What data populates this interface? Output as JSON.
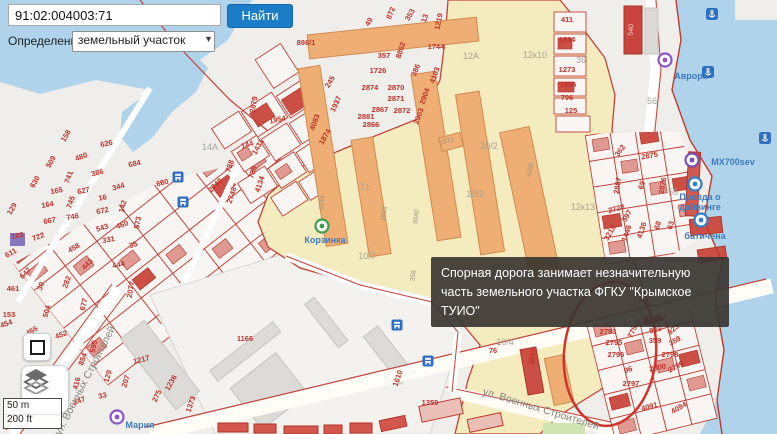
{
  "app": {
    "search_value": "91:02:004003:71",
    "search_button": "Найти",
    "definition_label": "Определение:",
    "definition_value": "земельный участок",
    "dropdown_chevron": "▾"
  },
  "tooltip": {
    "text": "Спорная дорога занимает незначительную часть земельного участка ФГКУ \"Крымское ТУИО\""
  },
  "scalebar": {
    "metric": "50 m",
    "imperial": "200 ft"
  },
  "colors": {
    "water": "#aed3ea",
    "land": "#f0eeea",
    "yellow_zone": "#f4ecbe",
    "orange_building": "#efae74",
    "red_building": "#cb4f44",
    "parcel_line": "#c2423a",
    "parcel_number": "#c0322a",
    "poi_blue": "#3d7cc0",
    "accent_blue": "#1a7dc6",
    "tooltip_bg": "#3b3733",
    "annotation_red": "#d0342c"
  },
  "map": {
    "labels": [
      {
        "t": "49",
        "x": 371,
        "y": 23,
        "r": -60
      },
      {
        "t": "872",
        "x": 393,
        "y": 14,
        "r": -68
      },
      {
        "t": "353",
        "x": 412,
        "y": 16,
        "r": -60
      },
      {
        "t": "13",
        "x": 427,
        "y": 19,
        "r": -72
      },
      {
        "t": "1219",
        "x": 441,
        "y": 22,
        "r": -78
      },
      {
        "t": "1744",
        "x": 436,
        "y": 49,
        "s": 9
      },
      {
        "t": "8862",
        "x": 403,
        "y": 51,
        "r": -72
      },
      {
        "t": "357",
        "x": 384,
        "y": 58
      },
      {
        "t": "1726",
        "x": 378,
        "y": 73
      },
      {
        "t": "386",
        "x": 418,
        "y": 71,
        "r": -68
      },
      {
        "t": "4103",
        "x": 437,
        "y": 76,
        "r": -70
      },
      {
        "t": "2874",
        "x": 370,
        "y": 90
      },
      {
        "t": "2870",
        "x": 396,
        "y": 90
      },
      {
        "t": "2904",
        "x": 427,
        "y": 97,
        "r": -70
      },
      {
        "t": "2871",
        "x": 396,
        "y": 101
      },
      {
        "t": "2867",
        "x": 380,
        "y": 112
      },
      {
        "t": "2872",
        "x": 402,
        "y": 113
      },
      {
        "t": "2903",
        "x": 421,
        "y": 117,
        "r": -70
      },
      {
        "t": "2881",
        "x": 366,
        "y": 119
      },
      {
        "t": "2866",
        "x": 371,
        "y": 127
      },
      {
        "t": "898/1",
        "x": 306,
        "y": 45,
        "s": 9
      },
      {
        "t": "411",
        "x": 567,
        "y": 22
      },
      {
        "t": "1834",
        "x": 567,
        "y": 42
      },
      {
        "t": "1273",
        "x": 567,
        "y": 72
      },
      {
        "t": "1856",
        "x": 568,
        "y": 87
      },
      {
        "t": "796",
        "x": 567,
        "y": 100
      },
      {
        "t": "125",
        "x": 571,
        "y": 113
      },
      {
        "t": "362",
        "x": 622,
        "y": 152,
        "r": -55
      },
      {
        "t": "2875",
        "x": 650,
        "y": 158,
        "r": -10
      },
      {
        "t": "2887",
        "x": 620,
        "y": 186,
        "r": -80
      },
      {
        "t": "69",
        "x": 644,
        "y": 186,
        "r": -72
      },
      {
        "t": "2876",
        "x": 665,
        "y": 186,
        "r": -80
      },
      {
        "t": "2728",
        "x": 617,
        "y": 211,
        "r": -15
      },
      {
        "t": "597",
        "x": 629,
        "y": 217,
        "r": -60
      },
      {
        "t": "3218",
        "x": 612,
        "y": 234,
        "r": -60
      },
      {
        "t": "1446",
        "x": 629,
        "y": 234,
        "r": -72
      },
      {
        "t": "4136",
        "x": 644,
        "y": 231,
        "r": -72
      },
      {
        "t": "68",
        "x": 660,
        "y": 226,
        "r": -72
      },
      {
        "t": "63",
        "x": 673,
        "y": 226,
        "r": -72
      },
      {
        "t": "2793",
        "x": 608,
        "y": 334
      },
      {
        "t": "775/1",
        "x": 636,
        "y": 330,
        "r": -65
      },
      {
        "t": "923",
        "x": 656,
        "y": 332,
        "r": -15
      },
      {
        "t": "923",
        "x": 675,
        "y": 331,
        "r": -42
      },
      {
        "t": "2795",
        "x": 614,
        "y": 345
      },
      {
        "t": "359",
        "x": 655,
        "y": 343
      },
      {
        "t": "359",
        "x": 676,
        "y": 343,
        "r": -30
      },
      {
        "t": "2796",
        "x": 616,
        "y": 357
      },
      {
        "t": "2798",
        "x": 670,
        "y": 357
      },
      {
        "t": "96",
        "x": 629,
        "y": 372,
        "r": -20
      },
      {
        "t": "2800",
        "x": 658,
        "y": 370,
        "r": -10
      },
      {
        "t": "2799",
        "x": 677,
        "y": 369,
        "r": -28
      },
      {
        "t": "2797",
        "x": 631,
        "y": 386
      },
      {
        "t": "4091",
        "x": 650,
        "y": 409,
        "r": -15
      },
      {
        "t": "4094",
        "x": 680,
        "y": 410,
        "r": -30
      },
      {
        "t": "2879",
        "x": 256,
        "y": 105,
        "r": -80
      },
      {
        "t": "1954",
        "x": 278,
        "y": 122,
        "r": -12
      },
      {
        "t": "245",
        "x": 332,
        "y": 83,
        "r": -60
      },
      {
        "t": "1937",
        "x": 338,
        "y": 105,
        "r": -65
      },
      {
        "t": "4083",
        "x": 317,
        "y": 123,
        "r": -70
      },
      {
        "t": "1874",
        "x": 327,
        "y": 138,
        "r": -60
      },
      {
        "t": "144",
        "x": 248,
        "y": 147,
        "r": -18
      },
      {
        "t": "1431",
        "x": 260,
        "y": 148,
        "r": -60
      },
      {
        "t": "788",
        "x": 232,
        "y": 167,
        "r": -70
      },
      {
        "t": "788",
        "x": 255,
        "y": 173,
        "r": -70
      },
      {
        "t": "4134",
        "x": 262,
        "y": 185,
        "r": -72
      },
      {
        "t": "2749",
        "x": 217,
        "y": 187,
        "r": -45
      },
      {
        "t": "2748",
        "x": 234,
        "y": 196,
        "r": -72
      },
      {
        "t": "158",
        "x": 68,
        "y": 137,
        "r": -60
      },
      {
        "t": "509",
        "x": 53,
        "y": 163,
        "r": -60
      },
      {
        "t": "480",
        "x": 82,
        "y": 159,
        "r": -20
      },
      {
        "t": "630",
        "x": 37,
        "y": 183,
        "r": -60
      },
      {
        "t": "741",
        "x": 71,
        "y": 178,
        "r": -70
      },
      {
        "t": "386",
        "x": 98,
        "y": 175,
        "r": -15
      },
      {
        "t": "344",
        "x": 119,
        "y": 189,
        "r": -15
      },
      {
        "t": "165",
        "x": 57,
        "y": 193,
        "r": -10
      },
      {
        "t": "627",
        "x": 84,
        "y": 193,
        "r": -12
      },
      {
        "t": "16",
        "x": 103,
        "y": 200,
        "r": -10
      },
      {
        "t": "129",
        "x": 14,
        "y": 210,
        "r": -60
      },
      {
        "t": "164",
        "x": 48,
        "y": 207,
        "r": -12
      },
      {
        "t": "745",
        "x": 73,
        "y": 203,
        "r": -70
      },
      {
        "t": "746",
        "x": 73,
        "y": 219,
        "r": -10
      },
      {
        "t": "142",
        "x": 125,
        "y": 207,
        "r": -75
      },
      {
        "t": "667",
        "x": 50,
        "y": 223,
        "r": -10
      },
      {
        "t": "672",
        "x": 103,
        "y": 213,
        "r": -12
      },
      {
        "t": "543",
        "x": 103,
        "y": 230,
        "r": -18
      },
      {
        "t": "460",
        "x": 123,
        "y": 227,
        "r": -20
      },
      {
        "t": "573",
        "x": 140,
        "y": 223,
        "r": -80
      },
      {
        "t": "722",
        "x": 39,
        "y": 239,
        "r": -20
      },
      {
        "t": "103",
        "x": 18,
        "y": 238,
        "r": -12
      },
      {
        "t": "331",
        "x": 109,
        "y": 242,
        "r": -12
      },
      {
        "t": "611",
        "x": 12,
        "y": 255,
        "r": -30
      },
      {
        "t": "458",
        "x": 75,
        "y": 250,
        "r": -30
      },
      {
        "t": "443",
        "x": 89,
        "y": 266,
        "r": -45
      },
      {
        "t": "455",
        "x": 33,
        "y": 333,
        "r": -30
      },
      {
        "t": "153",
        "x": 9,
        "y": 317
      },
      {
        "t": "454",
        "x": 7,
        "y": 326,
        "r": -20
      },
      {
        "t": "647",
        "x": 27,
        "y": 275,
        "r": -45
      },
      {
        "t": "461",
        "x": 13,
        "y": 291
      },
      {
        "t": "30",
        "x": 43,
        "y": 287,
        "r": -70
      },
      {
        "t": "504",
        "x": 49,
        "y": 312,
        "r": -75
      },
      {
        "t": "282",
        "x": 69,
        "y": 283,
        "r": -70
      },
      {
        "t": "677",
        "x": 86,
        "y": 305,
        "r": -75
      },
      {
        "t": "444",
        "x": 119,
        "y": 267,
        "r": -12
      },
      {
        "t": "35",
        "x": 134,
        "y": 247,
        "r": -18
      },
      {
        "t": "2077",
        "x": 133,
        "y": 290,
        "r": -80
      },
      {
        "t": "626",
        "x": 107,
        "y": 146,
        "r": -12,
        "s": 9
      },
      {
        "t": "684",
        "x": 135,
        "y": 166,
        "r": -12,
        "s": 9
      },
      {
        "t": "680",
        "x": 163,
        "y": 185,
        "r": -15,
        "s": 9
      },
      {
        "t": "452",
        "x": 62,
        "y": 337,
        "r": -20
      },
      {
        "t": "595",
        "x": 96,
        "y": 347,
        "r": -78
      },
      {
        "t": "854",
        "x": 85,
        "y": 360,
        "r": -70
      },
      {
        "t": "994",
        "x": 66,
        "y": 383,
        "r": -75
      },
      {
        "t": "416",
        "x": 79,
        "y": 384,
        "r": -75
      },
      {
        "t": "816",
        "x": 57,
        "y": 396,
        "r": -20
      },
      {
        "t": "247",
        "x": 80,
        "y": 403,
        "r": -20
      },
      {
        "t": "33",
        "x": 103,
        "y": 398,
        "r": -12
      },
      {
        "t": "129",
        "x": 110,
        "y": 377,
        "r": -72
      },
      {
        "t": "207",
        "x": 128,
        "y": 382,
        "r": -72
      },
      {
        "t": "1217",
        "x": 142,
        "y": 362,
        "r": -15
      },
      {
        "t": "275",
        "x": 159,
        "y": 397,
        "r": -65
      },
      {
        "t": "1236",
        "x": 173,
        "y": 384,
        "r": -60
      },
      {
        "t": "1373",
        "x": 193,
        "y": 405,
        "r": -70
      },
      {
        "t": "1166",
        "x": 245,
        "y": 341,
        "s": 9
      },
      {
        "t": "1359",
        "x": 430,
        "y": 405
      },
      {
        "t": "3623",
        "x": 535,
        "y": 357,
        "r": -85
      },
      {
        "t": "1610",
        "x": 400,
        "y": 379,
        "r": -72
      },
      {
        "t": "76",
        "x": 493,
        "y": 353,
        "s": 9
      },
      {
        "t": "1544",
        "x": 324,
        "y": 203,
        "r": -82,
        "c": "bn"
      },
      {
        "t": "1933",
        "x": 386,
        "y": 214,
        "r": -82,
        "c": "bn"
      },
      {
        "t": "9340",
        "x": 418,
        "y": 217,
        "r": -82,
        "c": "bn"
      },
      {
        "t": "4886",
        "x": 532,
        "y": 170,
        "r": -80,
        "c": "bn"
      },
      {
        "t": "1973",
        "x": 447,
        "y": 143,
        "r": -15,
        "c": "bn"
      },
      {
        "t": "358",
        "x": 415,
        "y": 276,
        "r": -82,
        "c": "bn"
      },
      {
        "t": "540",
        "x": 633,
        "y": 30,
        "r": -85,
        "c": "w"
      },
      {
        "t": "14А",
        "x": 210,
        "y": 150,
        "c": "g"
      },
      {
        "t": "12А",
        "x": 471,
        "y": 59,
        "c": "g"
      },
      {
        "t": "12к10",
        "x": 535,
        "y": 58,
        "c": "g"
      },
      {
        "t": "36",
        "x": 581,
        "y": 63,
        "c": "g"
      },
      {
        "t": "56",
        "x": 652,
        "y": 104,
        "c": "g"
      },
      {
        "t": "56",
        "x": 673,
        "y": 195,
        "c": "g"
      },
      {
        "t": "71",
        "x": 365,
        "y": 190,
        "c": "g"
      },
      {
        "t": "72",
        "x": 637,
        "y": 301,
        "c": "g"
      },
      {
        "t": "10/2",
        "x": 489,
        "y": 149,
        "c": "g"
      },
      {
        "t": "10/2",
        "x": 475,
        "y": 197,
        "c": "g"
      },
      {
        "t": "10/7",
        "x": 367,
        "y": 259,
        "c": "g"
      },
      {
        "t": "10/4",
        "x": 505,
        "y": 345,
        "c": "g"
      },
      {
        "t": "12к13",
        "x": 583,
        "y": 210,
        "c": "g"
      },
      {
        "t": "Аврора",
        "x": 691,
        "y": 79,
        "c": "b"
      },
      {
        "t": "МХ700sev",
        "x": 733,
        "y": 165,
        "c": "b"
      },
      {
        "t": "Правда о",
        "x": 700,
        "y": 200,
        "c": "b"
      },
      {
        "t": "дайвинге",
        "x": 700,
        "y": 210,
        "c": "b"
      },
      {
        "t": "батичена",
        "x": 705,
        "y": 239,
        "c": "b"
      },
      {
        "t": "Корзинка",
        "x": 325,
        "y": 243,
        "c": "b"
      },
      {
        "t": "Мария",
        "x": 140,
        "y": 428,
        "c": "b"
      },
      {
        "t": "ул. Военных Строителей",
        "x": 88,
        "y": 382,
        "r": -63,
        "c": "s"
      },
      {
        "t": "ул. Военных Строителей",
        "x": 540,
        "y": 412,
        "r": 17,
        "c": "s"
      }
    ],
    "icons": [
      {
        "k": "anchor",
        "x": 712,
        "y": 14,
        "n": "anchor-pier-icon"
      },
      {
        "k": "anchor",
        "x": 708,
        "y": 72,
        "n": "anchor-pier-icon"
      },
      {
        "k": "anchor",
        "x": 765,
        "y": 138,
        "n": "anchor-pier-icon"
      },
      {
        "k": "bus",
        "x": 178,
        "y": 177,
        "n": "bus-stop-icon"
      },
      {
        "k": "bus",
        "x": 183,
        "y": 202,
        "n": "bus-stop-icon"
      },
      {
        "k": "bus",
        "x": 397,
        "y": 325,
        "n": "bus-stop-icon"
      },
      {
        "k": "bus",
        "x": 428,
        "y": 361,
        "n": "bus-stop-icon"
      },
      {
        "k": "poi",
        "x": 665,
        "y": 60,
        "col": "#8a56c9",
        "n": "aurora-poi-icon"
      },
      {
        "k": "poi",
        "x": 692,
        "y": 160,
        "col": "#7a4fb0",
        "n": "mx700sev-poi-icon"
      },
      {
        "k": "poi",
        "x": 695,
        "y": 184,
        "col": "#2f80c7",
        "n": "diving-poi-icon"
      },
      {
        "k": "poi",
        "x": 701,
        "y": 220,
        "col": "#2f80c7",
        "n": "poi-icon"
      },
      {
        "k": "poi",
        "x": 322,
        "y": 226,
        "col": "#3f9d4f",
        "n": "korzinka-store-icon"
      },
      {
        "k": "poi",
        "x": 117,
        "y": 417,
        "col": "#8a56c9",
        "n": "maria-poi-icon"
      }
    ]
  }
}
